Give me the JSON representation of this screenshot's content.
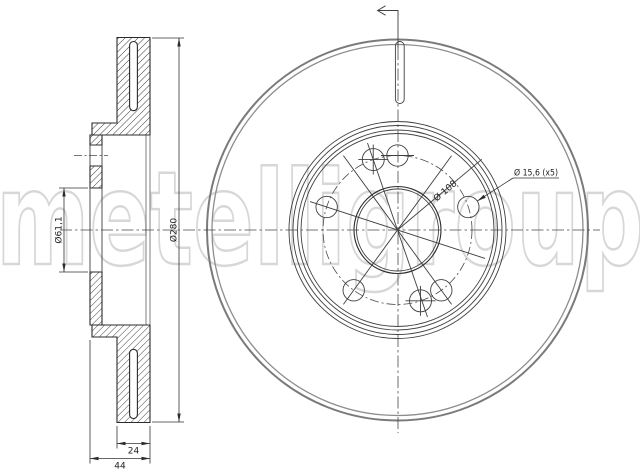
{
  "watermark": {
    "text": "metelligroup"
  },
  "colors": {
    "background": "#ffffff",
    "drawing_line": "#2b2b2b",
    "secondary_line": "#3f3f3f",
    "outer_circle_gray": "#7a7a7a",
    "watermark_gray": "#d7d7d7",
    "dimension_text": "#1f1f1f"
  },
  "section_view": {
    "dimensions": {
      "outer_diameter": "Ø280",
      "bore_diameter": "Ø61,1",
      "friction_ring_thickness": "24",
      "total_height": "44"
    }
  },
  "front_view": {
    "dimensions": {
      "bolt_circle_diameter": "Ø 108",
      "bolt_hole_diameter_count": "Ø 15,6 (x5)"
    }
  }
}
